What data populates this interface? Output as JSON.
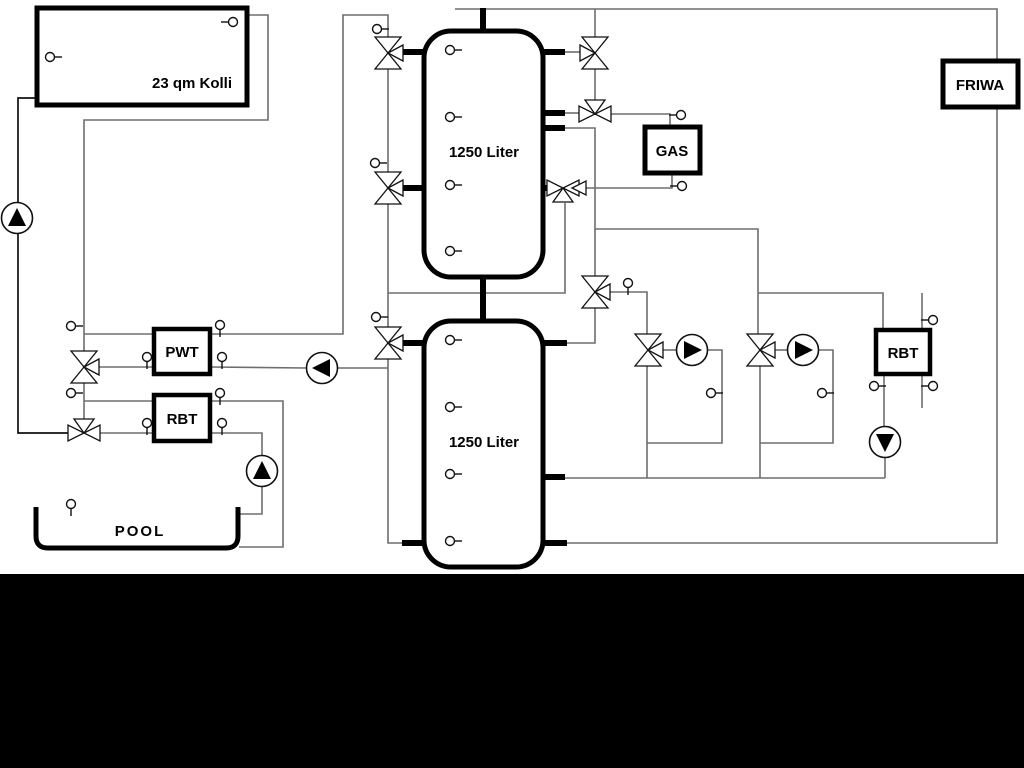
{
  "diagram": {
    "title": "Solar / pool / buffer-tank hydraulic schematic",
    "labels": {
      "collector": "23 qm Kolli",
      "tank_top": "1250 Liter",
      "tank_bottom": "1250 Liter",
      "gas": "GAS",
      "friwa": "FRIWA",
      "pwt": "PWT",
      "rbt_left": "RBT",
      "rbt_right": "RBT",
      "pool": "POOL"
    },
    "colors": {
      "pipe_gray": "#6e6e6e",
      "pipe_black": "#111111",
      "component_stroke": "#000000",
      "background": "#ffffff",
      "bottom_bar": "#000000"
    },
    "components": {
      "pumps": [
        {
          "name": "solar-pump",
          "direction": "up"
        },
        {
          "name": "pwt-pump",
          "direction": "left"
        },
        {
          "name": "pool-pump",
          "direction": "up"
        },
        {
          "name": "heating-circuit-1-pump",
          "direction": "right"
        },
        {
          "name": "heating-circuit-2-pump",
          "direction": "right"
        },
        {
          "name": "rbt-right-pump",
          "direction": "down"
        }
      ],
      "three_way_valves": 9,
      "check_valves": 1,
      "temperature_sensors": 24
    }
  }
}
